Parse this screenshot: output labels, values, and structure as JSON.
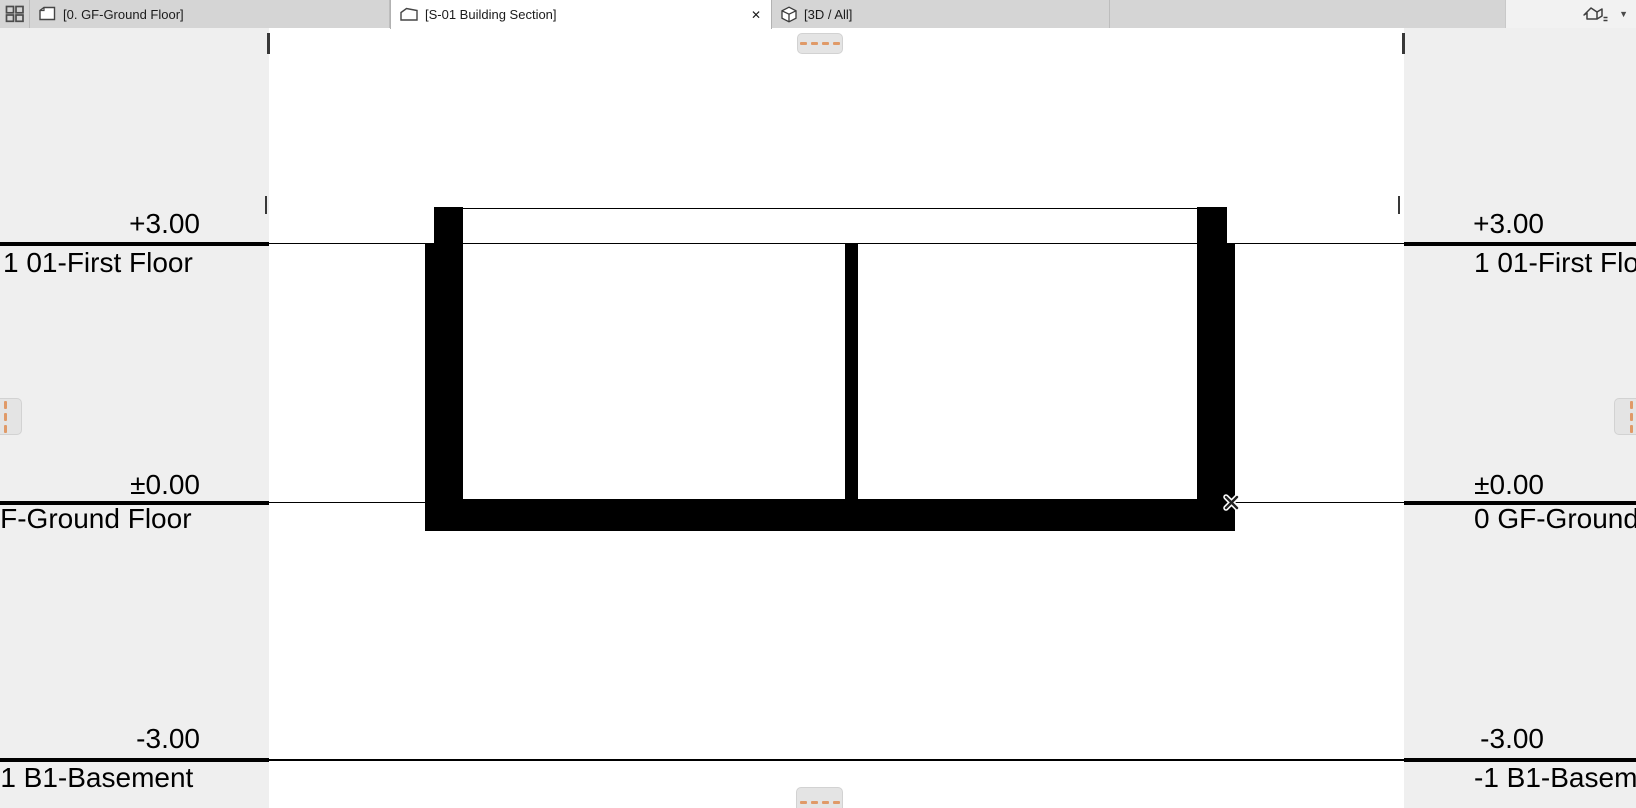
{
  "tab_bar": {
    "tabs": [
      {
        "label": "[0. GF-Ground Floor]",
        "icon": "floor-plan-icon",
        "active": false
      },
      {
        "label": "[S-01 Building Section]",
        "icon": "section-marker-icon",
        "active": true
      },
      {
        "label": "[3D / All]",
        "icon": "cube-3d-icon",
        "active": false
      }
    ]
  },
  "icons": {
    "close": "✕",
    "caret_down": "▼"
  },
  "section_view": {
    "levels": [
      {
        "elevation": "+3.00",
        "story": "1 01-First Floor"
      },
      {
        "elevation": "±0.00",
        "story": "0 GF-Ground Floor"
      },
      {
        "elevation": "-3.00",
        "story": "-1 B1-Basement"
      }
    ]
  },
  "colors": {
    "drawing_black": "#000000",
    "scroll_dash_orange": "#e09a68",
    "margin_gray": "#efefef",
    "tabbar_gray": "#d5d5d5",
    "active_tab_white": "#ffffff"
  }
}
